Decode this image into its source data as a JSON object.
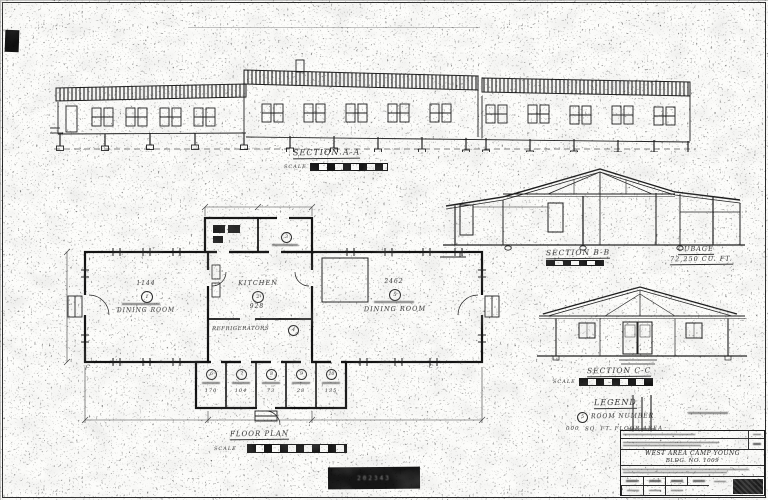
{
  "drawing": {
    "section_a": {
      "title": "SECTION A-A",
      "scale_word": "SCALE"
    },
    "section_b": {
      "title": "SECTION B-B"
    },
    "cubage": {
      "line1": "CUBAGE",
      "line2": "72,250 CU. FT."
    },
    "section_c": {
      "title": "SECTION C-C",
      "scale_word": "SCALE"
    },
    "legend": {
      "title": "LEGEND",
      "room_number_symbol": "5",
      "room_number_label": "ROOM NUMBER",
      "area_sample": "000",
      "area_label": "SQ. FT. FLOOR AREA"
    },
    "floor_plan": {
      "title": "FLOOR PLAN",
      "scale_word": "SCALE"
    }
  },
  "rooms": {
    "dining_left": {
      "area": "1144",
      "number": "1",
      "label": "DINING ROOM"
    },
    "kitchen": {
      "label": "KITCHEN",
      "number": "2",
      "area": "928"
    },
    "dining_right": {
      "area": "2462",
      "number": "5",
      "label": "DINING ROOM"
    },
    "refrigerators": {
      "label": "REFRIGERATORS",
      "number": "4"
    },
    "room_top": {
      "number": "3"
    },
    "small_rooms": [
      {
        "number": "6",
        "area": "170"
      },
      {
        "number": "7",
        "area": "104"
      },
      {
        "number": "8",
        "area": "73"
      },
      {
        "number": "9",
        "area": "28"
      },
      {
        "number": "10",
        "area": "135"
      }
    ],
    "markers": {
      "c_left": "C",
      "c_right": "C"
    }
  },
  "title_block": {
    "project": "WEST AREA CAMP YOUNG",
    "building": "BLDG. NO. 1009"
  },
  "stamps": {
    "center": "202343"
  }
}
